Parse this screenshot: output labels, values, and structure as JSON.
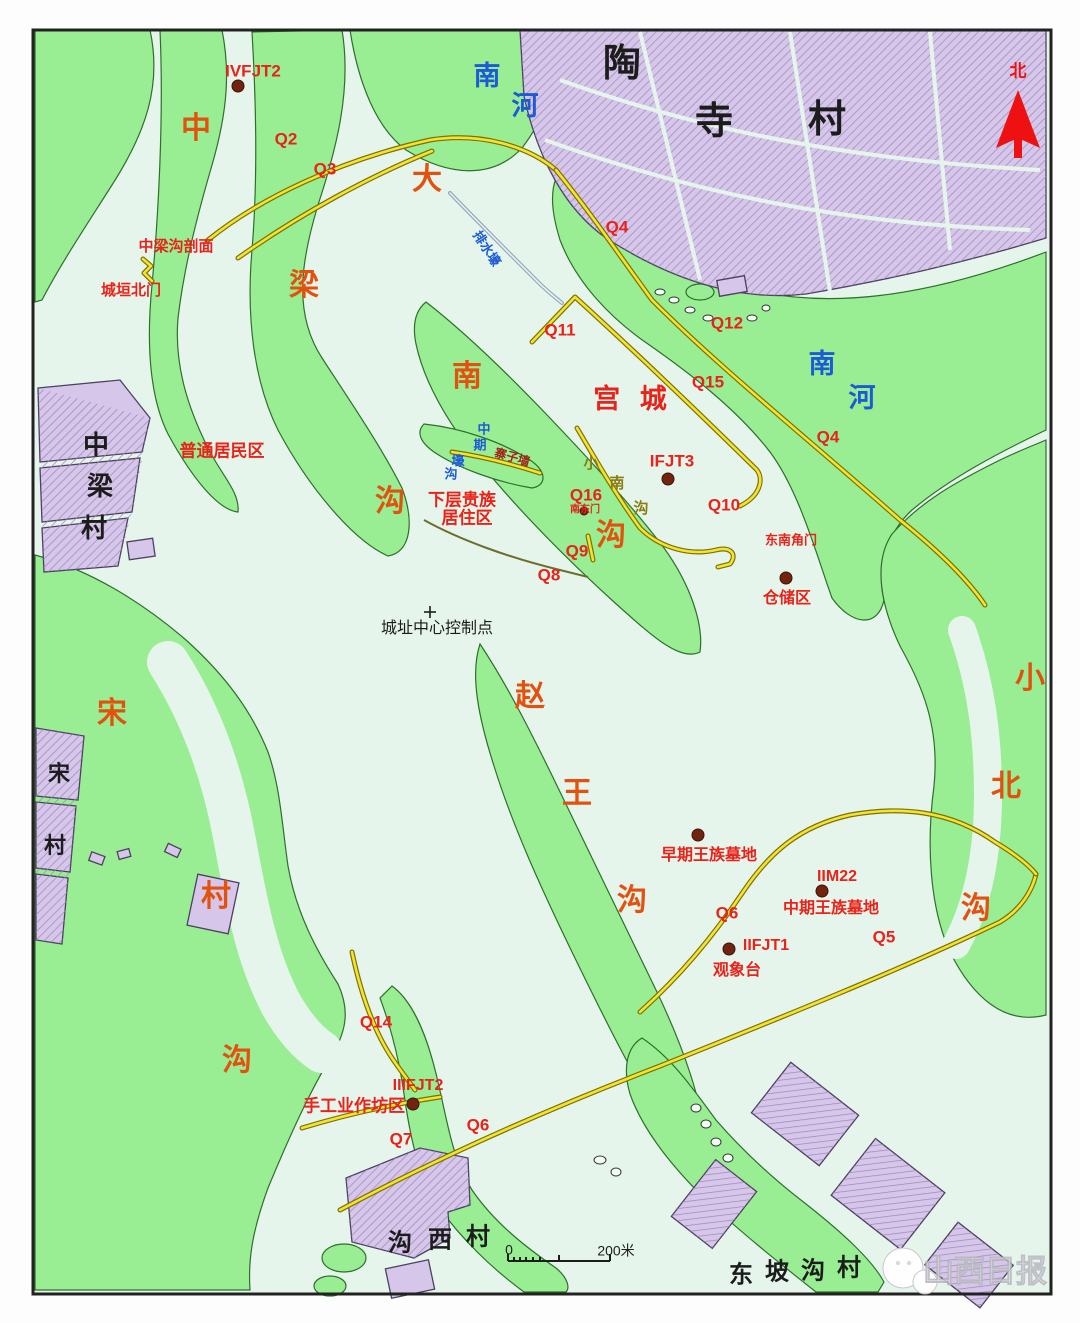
{
  "colors": {
    "map-bg": "#e6f5ec",
    "terrain-green": "#99ee93",
    "terrain-edge": "#2f6e2c",
    "village-purple": "#d6c6e9",
    "village-edge": "#4d4060",
    "road-yellow": "#f2e531",
    "road-casing": "#7e6f06",
    "label-red": "#e8231a",
    "gully-orange": "#e2520e",
    "river-blue": "#1d5bd6",
    "olive": "#8a7d10",
    "dark-red": "#a32318",
    "ink": "#1c1c1c",
    "marker-brown": "#722410",
    "north-red": "#ee1111"
  },
  "map": {
    "title_watermark": "山西日报",
    "north_label": "北",
    "scale_bar": {
      "zero": "0",
      "distance": "200米"
    },
    "labels": [
      {
        "text": "IVFJT2",
        "x": 253,
        "y": 72,
        "cls": "red",
        "size": 17,
        "name": "label-ivfjt2"
      },
      {
        "text": "Q2",
        "x": 286,
        "y": 140,
        "cls": "red",
        "size": 17,
        "name": "label-q2"
      },
      {
        "text": "Q3",
        "x": 325,
        "y": 170,
        "cls": "red",
        "size": 17,
        "name": "label-q3"
      },
      {
        "text": "中梁沟剖面",
        "x": 176,
        "y": 247,
        "cls": "red",
        "size": 15,
        "name": "label-zhongliang-gou-section"
      },
      {
        "text": "城垣北门",
        "x": 131,
        "y": 291,
        "cls": "red",
        "size": 15,
        "name": "label-north-gate"
      },
      {
        "text": "Q4",
        "x": 617,
        "y": 228,
        "cls": "red",
        "size": 17,
        "name": "label-q4-top"
      },
      {
        "text": "Q11",
        "x": 560,
        "y": 331,
        "cls": "red",
        "size": 17,
        "name": "label-q11"
      },
      {
        "text": "Q12",
        "x": 727,
        "y": 324,
        "cls": "red",
        "size": 17,
        "name": "label-q12"
      },
      {
        "text": "Q15",
        "x": 708,
        "y": 383,
        "cls": "red",
        "size": 17,
        "name": "label-q15"
      },
      {
        "text": "Q4",
        "x": 828,
        "y": 438,
        "cls": "red",
        "size": 17,
        "name": "label-q4-right"
      },
      {
        "text": "宫 城",
        "x": 633,
        "y": 401,
        "cls": "red",
        "size": 27,
        "spacing": 6,
        "name": "label-palace-city"
      },
      {
        "text": "IFJT3",
        "x": 672,
        "y": 462,
        "cls": "red",
        "size": 17,
        "name": "label-ifjt3"
      },
      {
        "text": "Q16",
        "x": 586,
        "y": 496,
        "cls": "red",
        "size": 17,
        "name": "label-q16"
      },
      {
        "text": "南东门",
        "x": 585,
        "y": 510,
        "cls": "red",
        "size": 10,
        "name": "label-se-gate-small"
      },
      {
        "text": "Q10",
        "x": 724,
        "y": 506,
        "cls": "red",
        "size": 17,
        "name": "label-q10"
      },
      {
        "text": "东南角门",
        "x": 791,
        "y": 541,
        "cls": "red",
        "size": 13,
        "name": "label-southeast-corner-gate"
      },
      {
        "text": "下层贵族",
        "x": 462,
        "y": 501,
        "cls": "red",
        "size": 17,
        "name": "label-lower-nobles-1"
      },
      {
        "text": "居住区",
        "x": 467,
        "y": 519,
        "cls": "red",
        "size": 17,
        "name": "label-lower-nobles-2"
      },
      {
        "text": "Q9",
        "x": 577,
        "y": 552,
        "cls": "red",
        "size": 17,
        "name": "label-q9"
      },
      {
        "text": "Q8",
        "x": 549,
        "y": 576,
        "cls": "red",
        "size": 17,
        "name": "label-q8"
      },
      {
        "text": "仓储区",
        "x": 787,
        "y": 599,
        "cls": "red",
        "size": 16,
        "name": "label-storage-area"
      },
      {
        "text": "普通居民区",
        "x": 222,
        "y": 452,
        "cls": "red",
        "size": 17,
        "name": "label-common-residents"
      },
      {
        "text": "早期王族墓地",
        "x": 709,
        "y": 856,
        "cls": "red",
        "size": 16,
        "name": "label-early-royal-cemetery"
      },
      {
        "text": "IIM22",
        "x": 837,
        "y": 877,
        "cls": "red",
        "size": 16,
        "name": "label-iim22"
      },
      {
        "text": "中期王族墓地",
        "x": 831,
        "y": 909,
        "cls": "red",
        "size": 16,
        "name": "label-middle-royal-cemetery"
      },
      {
        "text": "Q6",
        "x": 727,
        "y": 914,
        "cls": "red",
        "size": 17,
        "name": "label-q6"
      },
      {
        "text": "IIFJT1",
        "x": 766,
        "y": 946,
        "cls": "red",
        "size": 16,
        "name": "label-iifjt1"
      },
      {
        "text": "观象台",
        "x": 737,
        "y": 971,
        "cls": "red",
        "size": 16,
        "name": "label-observatory"
      },
      {
        "text": "Q5",
        "x": 884,
        "y": 938,
        "cls": "red",
        "size": 17,
        "name": "label-q5"
      },
      {
        "text": "Q14",
        "x": 376,
        "y": 1023,
        "cls": "red",
        "size": 17,
        "name": "label-q14"
      },
      {
        "text": "IIIFJT2",
        "x": 418,
        "y": 1086,
        "cls": "red",
        "size": 16,
        "name": "label-iiifjt2"
      },
      {
        "text": "手工业作坊区",
        "x": 354,
        "y": 1107,
        "cls": "red",
        "size": 17,
        "name": "label-handicraft-area"
      },
      {
        "text": "Q7",
        "x": 401,
        "y": 1140,
        "cls": "red",
        "size": 17,
        "name": "label-q7"
      },
      {
        "text": "Q6",
        "x": 478,
        "y": 1126,
        "cls": "red",
        "size": 17,
        "name": "label-q6-bottom"
      },
      {
        "text": "中",
        "x": 196,
        "y": 130,
        "cls": "orange",
        "size": 30,
        "name": "gully-zhong"
      },
      {
        "text": "梁",
        "x": 304,
        "y": 287,
        "cls": "orange",
        "size": 30,
        "name": "gully-liang"
      },
      {
        "text": "沟",
        "x": 390,
        "y": 503,
        "cls": "orange",
        "size": 30,
        "name": "gully-gou-1"
      },
      {
        "text": "大",
        "x": 427,
        "y": 181,
        "cls": "orange",
        "size": 30,
        "name": "gully-da"
      },
      {
        "text": "南",
        "x": 467,
        "y": 378,
        "cls": "orange",
        "size": 30,
        "name": "gully-nan"
      },
      {
        "text": "沟",
        "x": 611,
        "y": 537,
        "cls": "orange",
        "size": 30,
        "name": "gully-gou-2"
      },
      {
        "text": "赵",
        "x": 530,
        "y": 698,
        "cls": "orange",
        "size": 30,
        "name": "gully-zhao"
      },
      {
        "text": "王",
        "x": 577,
        "y": 795,
        "cls": "orange",
        "size": 30,
        "name": "gully-wang"
      },
      {
        "text": "沟",
        "x": 632,
        "y": 902,
        "cls": "orange",
        "size": 30,
        "name": "gully-gou-3"
      },
      {
        "text": "宋",
        "x": 112,
        "y": 715,
        "cls": "orange",
        "size": 30,
        "name": "gully-song"
      },
      {
        "text": "村",
        "x": 216,
        "y": 898,
        "cls": "orange",
        "size": 30,
        "name": "gully-cun"
      },
      {
        "text": "沟",
        "x": 237,
        "y": 1062,
        "cls": "orange",
        "size": 30,
        "name": "gully-gou-4"
      },
      {
        "text": "小",
        "x": 1030,
        "y": 680,
        "cls": "orange",
        "size": 30,
        "name": "gully-xiao"
      },
      {
        "text": "北",
        "x": 1006,
        "y": 788,
        "cls": "orange",
        "size": 30,
        "name": "gully-bei"
      },
      {
        "text": "沟",
        "x": 976,
        "y": 910,
        "cls": "orange",
        "size": 30,
        "name": "gully-gou-5"
      },
      {
        "text": "南",
        "x": 487,
        "y": 78,
        "cls": "blue",
        "size": 27,
        "name": "river-nan-top"
      },
      {
        "text": "河",
        "x": 525,
        "y": 108,
        "cls": "blue",
        "size": 27,
        "name": "river-he-top"
      },
      {
        "text": "南",
        "x": 822,
        "y": 366,
        "cls": "blue",
        "size": 27,
        "name": "river-nan-right"
      },
      {
        "text": "河",
        "x": 862,
        "y": 400,
        "cls": "blue",
        "size": 27,
        "name": "river-he-right"
      },
      {
        "text": "排水壕",
        "x": 486,
        "y": 249,
        "cls": "blue",
        "size": 13,
        "rotate": 57,
        "name": "label-drainage-trench"
      },
      {
        "text": "中",
        "x": 484,
        "y": 430,
        "cls": "blue",
        "size": 13,
        "name": "label-middle-period-1"
      },
      {
        "text": "期",
        "x": 480,
        "y": 446,
        "cls": "blue",
        "size": 13,
        "name": "label-middle-period-2"
      },
      {
        "text": "寨子墙",
        "x": 512,
        "y": 458,
        "cls": "darkred",
        "size": 12,
        "rotate": 16,
        "name": "label-stockade-wall"
      },
      {
        "text": "壕",
        "x": 458,
        "y": 462,
        "cls": "blue",
        "size": 13,
        "name": "label-moat-1"
      },
      {
        "text": "沟",
        "x": 451,
        "y": 475,
        "cls": "blue",
        "size": 13,
        "name": "label-moat-2"
      },
      {
        "text": "小",
        "x": 591,
        "y": 464,
        "cls": "olive",
        "size": 15,
        "name": "label-xiaonangou-1"
      },
      {
        "text": "南",
        "x": 617,
        "y": 484,
        "cls": "olive",
        "size": 15,
        "name": "label-xiaonangou-2"
      },
      {
        "text": "沟",
        "x": 641,
        "y": 509,
        "cls": "olive",
        "size": 15,
        "name": "label-xiaonangou-3"
      },
      {
        "text": "陶",
        "x": 622,
        "y": 66,
        "cls": "black",
        "size": 38,
        "name": "village-taosi-1"
      },
      {
        "text": "寺",
        "x": 714,
        "y": 124,
        "cls": "black",
        "size": 38,
        "name": "village-taosi-2"
      },
      {
        "text": "村",
        "x": 827,
        "y": 122,
        "cls": "black",
        "size": 38,
        "name": "village-taosi-3"
      },
      {
        "text": "中",
        "x": 96,
        "y": 447,
        "cls": "black",
        "size": 26,
        "name": "village-zhongliang-1"
      },
      {
        "text": "梁",
        "x": 100,
        "y": 488,
        "cls": "black",
        "size": 26,
        "name": "village-zhongliang-2"
      },
      {
        "text": "村",
        "x": 94,
        "y": 530,
        "cls": "black",
        "size": 26,
        "name": "village-zhongliang-3"
      },
      {
        "text": "城址中心控制点",
        "x": 437,
        "y": 629,
        "cls": "blackthin",
        "size": 16,
        "name": "label-site-center-control-point"
      },
      {
        "text": "宋",
        "x": 59,
        "y": 775,
        "cls": "black",
        "size": 22,
        "name": "village-song-1"
      },
      {
        "text": "村",
        "x": 55,
        "y": 847,
        "cls": "black",
        "size": 22,
        "name": "village-song-2"
      },
      {
        "text": "沟",
        "x": 400,
        "y": 1244,
        "cls": "black",
        "size": 24,
        "name": "village-gouxi-1"
      },
      {
        "text": "西",
        "x": 440,
        "y": 1241,
        "cls": "black",
        "size": 24,
        "name": "village-gouxi-2"
      },
      {
        "text": "村",
        "x": 478,
        "y": 1238,
        "cls": "black",
        "size": 24,
        "name": "village-gouxi-3"
      },
      {
        "text": "东",
        "x": 741,
        "y": 1276,
        "cls": "black",
        "size": 24,
        "name": "village-dongpogou-1"
      },
      {
        "text": "坡",
        "x": 777,
        "y": 1273,
        "cls": "black",
        "size": 24,
        "name": "village-dongpogou-2"
      },
      {
        "text": "沟",
        "x": 813,
        "y": 1272,
        "cls": "black",
        "size": 24,
        "name": "village-dongpogou-3"
      },
      {
        "text": "村",
        "x": 849,
        "y": 1269,
        "cls": "black",
        "size": 24,
        "name": "village-dongpogou-4"
      }
    ],
    "markers": [
      {
        "x": 238,
        "y": 86,
        "r": 6,
        "name": "marker-ivfjt2"
      },
      {
        "x": 668,
        "y": 479,
        "r": 6,
        "name": "marker-ifjt3"
      },
      {
        "x": 786,
        "y": 578,
        "r": 6,
        "name": "marker-storage"
      },
      {
        "x": 698,
        "y": 835,
        "r": 6,
        "name": "marker-early-cemetery"
      },
      {
        "x": 822,
        "y": 891,
        "r": 6,
        "name": "marker-iim22"
      },
      {
        "x": 729,
        "y": 949,
        "r": 6,
        "name": "marker-iifjt1"
      },
      {
        "x": 413,
        "y": 1104,
        "r": 6,
        "name": "marker-iiifjt2"
      },
      {
        "x": 584,
        "y": 511,
        "r": 4,
        "name": "marker-se-gate"
      }
    ]
  }
}
